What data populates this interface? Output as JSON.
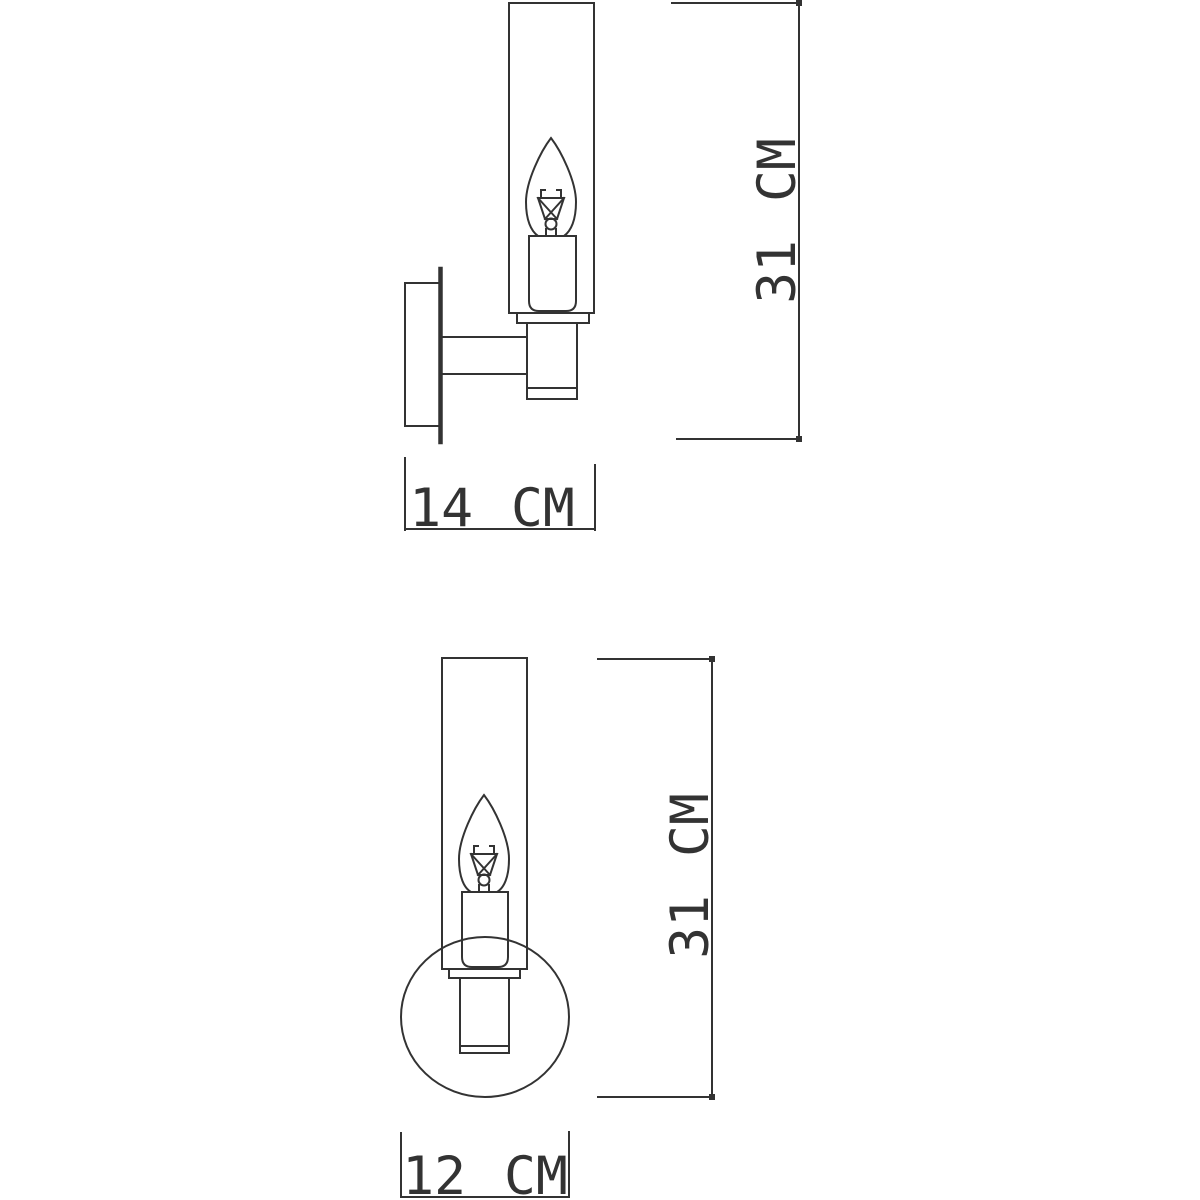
{
  "drawing": {
    "background_color": "#ffffff",
    "line_color": "#333333",
    "unit": "CM"
  },
  "views": {
    "side": {
      "height_label": "31 CM",
      "depth_label": "14 CM"
    },
    "front": {
      "height_label": "31 CM",
      "width_label": "12 CM"
    }
  }
}
